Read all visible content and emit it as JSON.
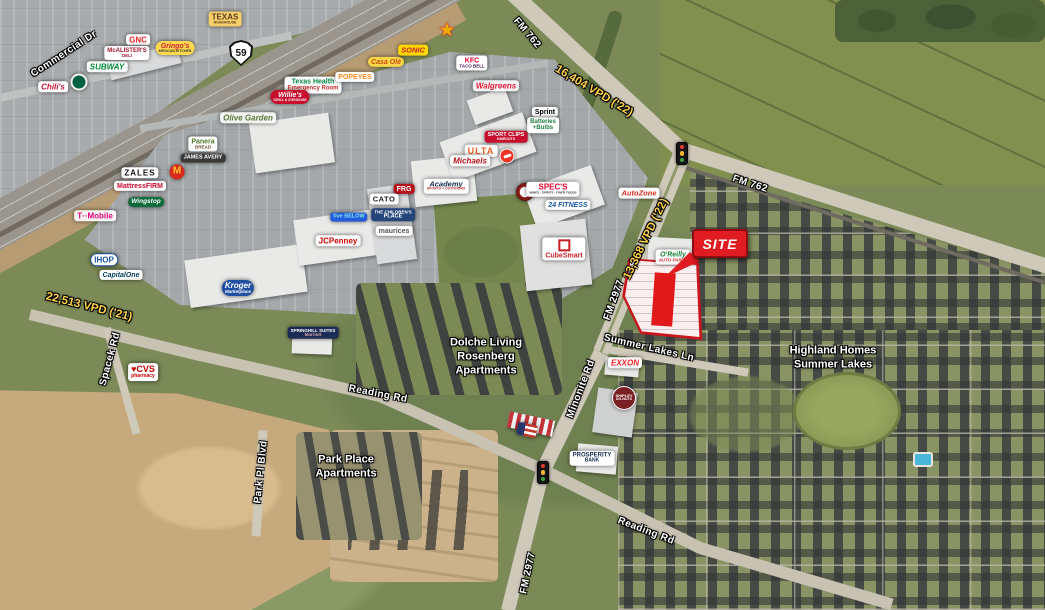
{
  "map": {
    "title": "Aerial retail map - US 59 & FM 762 / FM 2977 Rosenberg",
    "site_callout": {
      "label": "SITE"
    },
    "highway_shield": {
      "route": "59"
    },
    "colors": {
      "site_red": "#e11b22",
      "vpd_yellow": "#ffd24a",
      "road_label_white": "#ffffff",
      "parcel_outline_red": "#c9161d"
    },
    "roads": [
      {
        "label": "Commercial Dr"
      },
      {
        "label": "FM 762"
      },
      {
        "label": "FM 762"
      },
      {
        "label": "FM 2977"
      },
      {
        "label": "Minonite Rd"
      },
      {
        "label": "Summer Lakes Ln"
      },
      {
        "label": "Reading Rd"
      },
      {
        "label": "Reading Rd"
      },
      {
        "label": "Spacek Rd"
      },
      {
        "label": "Park Pl Blvd"
      },
      {
        "label": "FM 2977"
      }
    ],
    "traffic_counts": [
      {
        "label": "22,513 VPD ('21)"
      },
      {
        "label": "16,404 VPD ('22)"
      },
      {
        "label": "13,368 VPD ('22)"
      }
    ],
    "area_labels": [
      {
        "label": "Dolche Living\nRosenberg\nApartments"
      },
      {
        "label": "Park Place\nApartments"
      },
      {
        "label": "Highland Homes\nSummer Lakes"
      }
    ],
    "logos": [
      {
        "id": "chilis",
        "label": "Chili's"
      },
      {
        "id": "starbucks",
        "label": ""
      },
      {
        "id": "subway",
        "label": "SUBWAY"
      },
      {
        "id": "gnc",
        "label": "GNC"
      },
      {
        "id": "mcalisters",
        "label": "McALISTER'S",
        "sub": "DELI"
      },
      {
        "id": "gringos",
        "label": "Gringo's",
        "sub": "MEXICAN KITCHEN"
      },
      {
        "id": "texas-roadhouse",
        "label": "TEXAS",
        "sub": "ROADHOUSE"
      },
      {
        "id": "texas-health",
        "label": "Texas Health",
        "sub": "Emergency Room"
      },
      {
        "id": "willies",
        "label": "Willie's",
        "sub": "GRILL & ICEHOUSE"
      },
      {
        "id": "olive-garden",
        "label": "Olive Garden"
      },
      {
        "id": "panera",
        "label": "Panera",
        "sub": "BREAD"
      },
      {
        "id": "james-avery",
        "label": "JAMES AVERY"
      },
      {
        "id": "popeyes",
        "label": "POPEYES"
      },
      {
        "id": "casa-ole",
        "label": "Casa Olé"
      },
      {
        "id": "sonic",
        "label": "SONIC"
      },
      {
        "id": "carls-jr",
        "label": "★"
      },
      {
        "id": "kfc-tacobell",
        "label": "KFC",
        "sub": "TACO BELL"
      },
      {
        "id": "walgreens",
        "label": "Walgreens"
      },
      {
        "id": "zales",
        "label": "ZALES"
      },
      {
        "id": "mcdonalds",
        "label": "M"
      },
      {
        "id": "mattressfirm",
        "label": "MattressFIRM"
      },
      {
        "id": "wingstop",
        "label": "Wingstop"
      },
      {
        "id": "tmobile",
        "label": "T··Mobile"
      },
      {
        "id": "ihop",
        "label": "IHOP"
      },
      {
        "id": "capitalone",
        "label": "CapitalOne"
      },
      {
        "id": "kroger",
        "label": "Kroger",
        "sub": "Marketplace"
      },
      {
        "id": "jcpenney",
        "label": "JCPenney"
      },
      {
        "id": "fivebelow",
        "label": "five BELOW"
      },
      {
        "id": "frg",
        "label": "FRG"
      },
      {
        "id": "cato",
        "label": "CATO"
      },
      {
        "id": "childrens-place",
        "label": "THE CHILDREN'S",
        "sub": "PLACE"
      },
      {
        "id": "maurices",
        "label": "maurices"
      },
      {
        "id": "academy",
        "label": "Academy",
        "sub": "SPORTS + OUTDOORS"
      },
      {
        "id": "ulta",
        "label": "ULTA"
      },
      {
        "id": "michaels",
        "label": "Michaels"
      },
      {
        "id": "sportclips",
        "label": "SPORT CLIPS",
        "sub": "HAIRCUTS"
      },
      {
        "id": "pizzahut",
        "label": ""
      },
      {
        "id": "sprint",
        "label": "Sprint"
      },
      {
        "id": "batteries-bulbs",
        "label": "Batteries",
        "sub": "+Bulbs"
      },
      {
        "id": "round-badge",
        "label": ""
      },
      {
        "id": "specs",
        "label": "SPEC'S",
        "sub": "WINES · SPIRITS · FINER FOODS"
      },
      {
        "id": "24hour-fitness",
        "label": "24 FITNESS"
      },
      {
        "id": "cubesmart",
        "label": "CubeSmart"
      },
      {
        "id": "autozone",
        "label": "AutoZone"
      },
      {
        "id": "oreilly",
        "label": "O'Reilly",
        "sub": "AUTO PARTS"
      },
      {
        "id": "exxon",
        "label": "EXXON"
      },
      {
        "id": "shipley",
        "label": "SHIPLEY",
        "sub": "DO-NUTS"
      },
      {
        "id": "us-flag",
        "label": ""
      },
      {
        "id": "prosperity-bank",
        "label": "PROSPERITY",
        "sub": "BANK"
      },
      {
        "id": "springhill-suites",
        "label": "SPRINGHILL SUITES",
        "sub": "Marriott"
      },
      {
        "id": "cvs",
        "label": "♥CVS",
        "sub": "pharmacy"
      }
    ]
  }
}
